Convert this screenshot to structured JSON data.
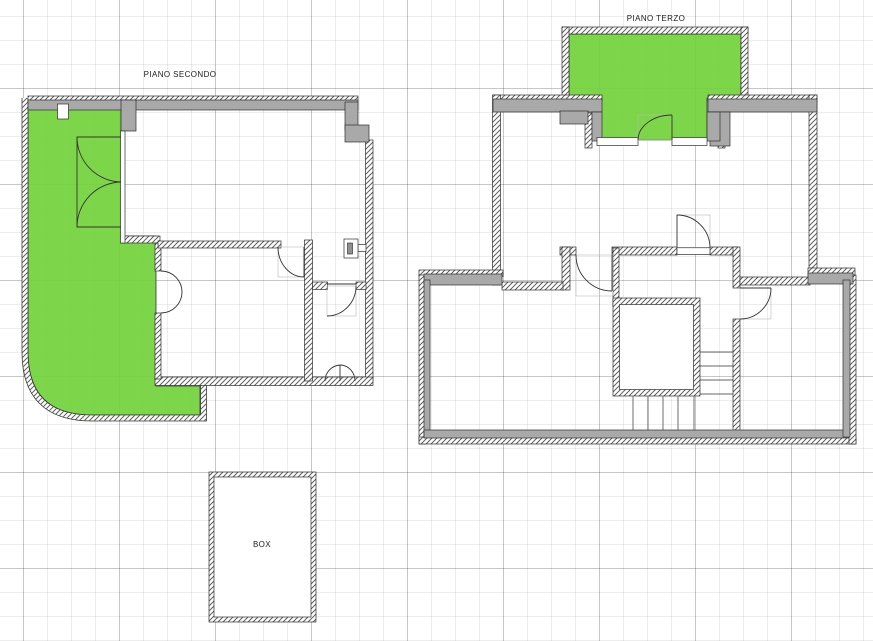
{
  "drawing": {
    "floor_plans": [
      {
        "label": "PIANO SECONDO"
      },
      {
        "label": "PIANO TERZO"
      }
    ],
    "garage_label": "BOX"
  },
  "colors": {
    "highlight_green": "#72d33a",
    "wall_gray": "#a9a9a9",
    "wall_outline": "#2e2e2e",
    "door_line": "#333333",
    "door_frame": "#b8b8b8",
    "background": "#ffffff",
    "grid_minor": "rgba(0,0,0,0.07)",
    "grid_major": "rgba(0,0,0,0.16)"
  }
}
